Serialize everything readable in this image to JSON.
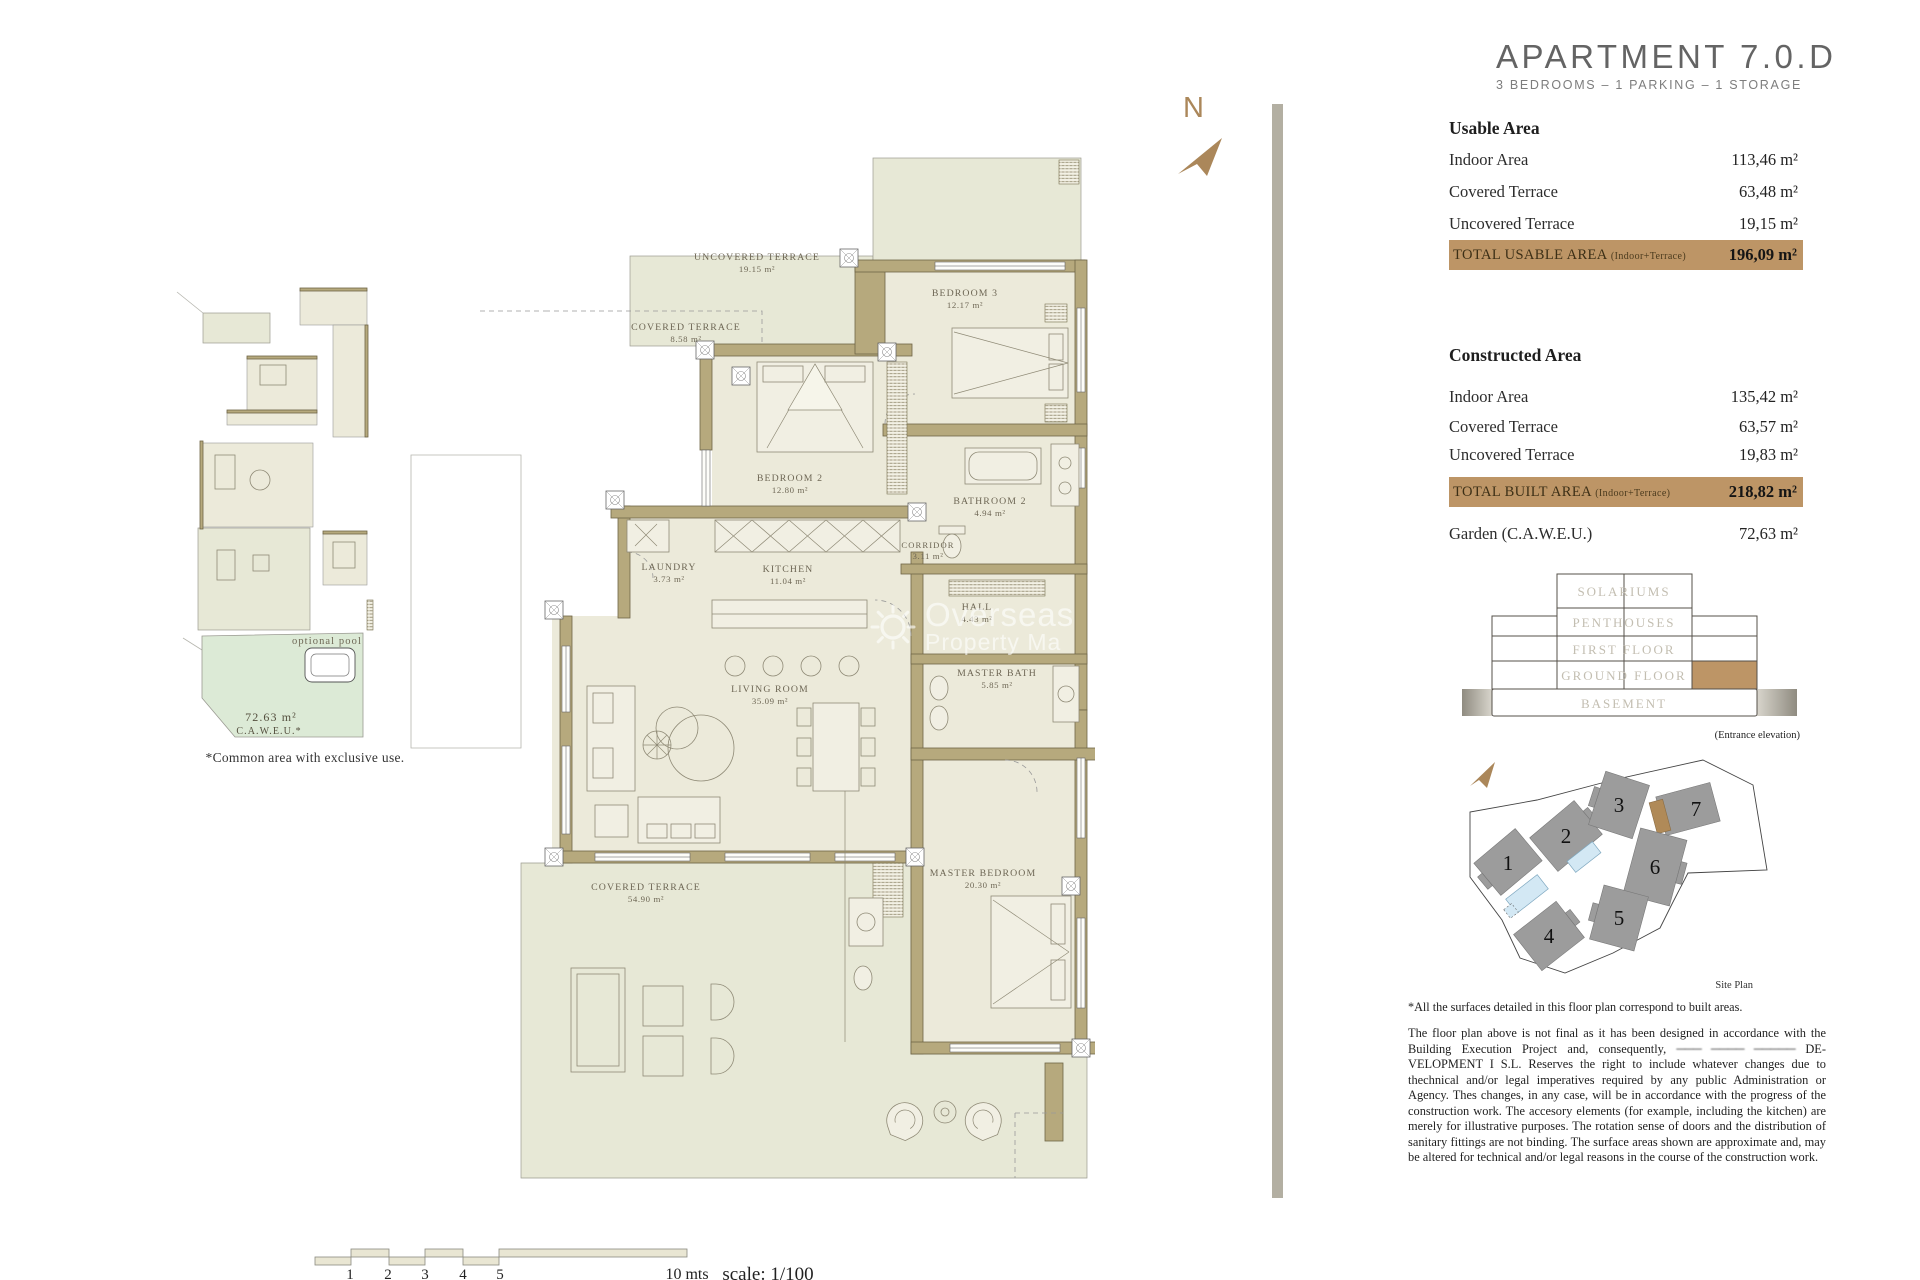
{
  "title": {
    "name": "APARTMENT 7.0.D",
    "subtitle": "3 BEDROOMS – 1 PARKING – 1 STORAGE"
  },
  "usable_area": {
    "heading": "Usable Area",
    "rows": [
      {
        "label": "Indoor Area",
        "value": "113,46 m²"
      },
      {
        "label": "Covered Terrace",
        "value": "63,48 m²"
      },
      {
        "label": "Uncovered Terrace",
        "value": "19,15 m²"
      }
    ],
    "total_label": "TOTAL USABLE AREA",
    "total_note": "(Indoor+Terrace)",
    "total_value": "196,09 m²"
  },
  "constructed_area": {
    "heading": "Constructed Area",
    "rows": [
      {
        "label": "Indoor Area",
        "value": "135,42 m²"
      },
      {
        "label": "Covered Terrace",
        "value": "63,57 m²"
      },
      {
        "label": "Uncovered Terrace",
        "value": "19,83 m²"
      }
    ],
    "total_label": "TOTAL BUILT AREA",
    "total_note": "(Indoor+Terrace)",
    "total_value": "218,82 m²",
    "garden_label": "Garden (C.A.W.E.U.)",
    "garden_value": "72,63 m²"
  },
  "elevation": {
    "floors": [
      "SOLARIUMS",
      "PENTHOUSES",
      "FIRST FLOOR",
      "GROUND FLOOR",
      "BASEMENT"
    ],
    "caption": "(Entrance elevation)"
  },
  "site_plan": {
    "buildings": [
      "1",
      "2",
      "3",
      "4",
      "5",
      "6",
      "7"
    ],
    "caption": "Site Plan"
  },
  "notes": {
    "surfaces_note": "*All the surfaces detailed in this floor plan correspond to built areas.",
    "disclaimer_pre": "The floor plan above is not final as it has been designed in accordance with the Building Execution Project and, consequently, ",
    "disclaimer_redacted": "─── ──── ─────",
    "disclaimer_post": " DE-VELOPMENT I S.L. Reserves the right to include whatever changes due to thechnical and/or legal imperatives required by any public Administration or Agency. Thes changes, in any case, will be in accordance with the progress of the construction work. The accesory elements  (for example, including the kitchen) are merely for illustrative purposes. The rotation sense of doors and the distribution of sanitary fittings are not binding. The surface areas shown are approximate and, may be altered for technical and/or legal reasons in the course of the construction work."
  },
  "rooms": {
    "uncovered_terrace": {
      "name": "UNCOVERED TERRACE",
      "area": "19.15 m²"
    },
    "covered_terrace_small": {
      "name": "COVERED TERRACE",
      "area": "8.58 m²"
    },
    "bedroom3": {
      "name": "BEDROOM 3",
      "area": "12.17 m²"
    },
    "bedroom2": {
      "name": "BEDROOM 2",
      "area": "12.80 m²"
    },
    "bathroom2": {
      "name": "BATHROOM 2",
      "area": "4.94 m²"
    },
    "corridor": {
      "name": "CORRIDOR",
      "area": "3.11 m²"
    },
    "laundry": {
      "name": "LAUNDRY",
      "area": "3.73 m²"
    },
    "kitchen": {
      "name": "KITCHEN",
      "area": "11.04 m²"
    },
    "hall": {
      "name": "HALL",
      "area": "4.43 m²"
    },
    "master_bath": {
      "name": "MASTER BATH",
      "area": "5.85 m²"
    },
    "living_room": {
      "name": "LIVING ROOM",
      "area": "35.09 m²"
    },
    "master_bedroom": {
      "name": "MASTER BEDROOM",
      "area": "20.30 m²"
    },
    "covered_terrace_large": {
      "name": "COVERED TERRACE",
      "area": "54.90 m²"
    }
  },
  "mini_plan": {
    "pool_label": "optional pool",
    "garden_area": "72.63 m²",
    "garden_note": "C.A.W.E.U.*",
    "caption": "*Common area with exclusive use."
  },
  "scale_bar": {
    "ticks": [
      "1",
      "2",
      "3",
      "4",
      "5"
    ],
    "end_label": "10 mts",
    "scale_label": "scale: 1/100"
  },
  "watermark": {
    "line1": "Overseas",
    "line2": "Property Ma"
  },
  "compass": {
    "letter": "N"
  },
  "colors": {
    "accent_tan": "#bd9566",
    "wall": "#b6a97d",
    "garden": "#dcead6",
    "pool": "#d3e8f4",
    "divider": "#b3afa2",
    "compass": "#ab875a"
  }
}
